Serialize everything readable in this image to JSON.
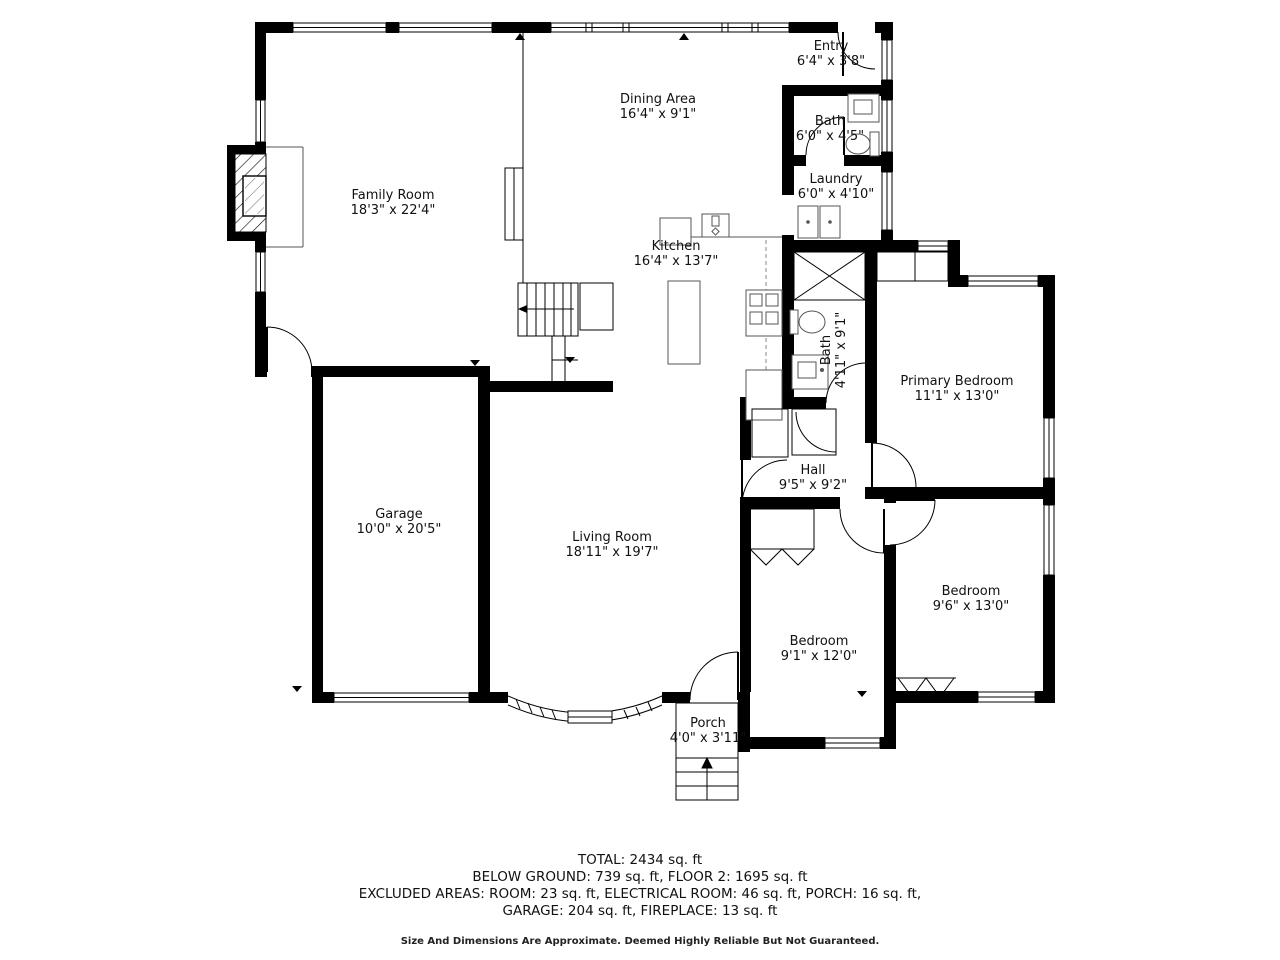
{
  "rooms": [
    {
      "name": "Entry",
      "dims": "6'4\" x 3'8\""
    },
    {
      "name": "Bath",
      "dims": "6'0\" x 4'5\""
    },
    {
      "name": "Laundry",
      "dims": "6'0\" x 4'10\""
    },
    {
      "name": "Dining Area",
      "dims": "16'4\" x 9'1\""
    },
    {
      "name": "Family Room",
      "dims": "18'3\" x 22'4\""
    },
    {
      "name": "Kitchen",
      "dims": "16'4\" x 13'7\""
    },
    {
      "name": "Bath",
      "dims": "4'11\" x 9'1\""
    },
    {
      "name": "Primary Bedroom",
      "dims": "11'1\" x 13'0\""
    },
    {
      "name": "Hall",
      "dims": "9'5\" x 9'2\""
    },
    {
      "name": "Garage",
      "dims": "10'0\" x 20'5\""
    },
    {
      "name": "Living Room",
      "dims": "18'11\" x 19'7\""
    },
    {
      "name": "Bedroom",
      "dims": "9'1\" x 12'0\""
    },
    {
      "name": "Bedroom",
      "dims": "9'6\" x 13'0\""
    },
    {
      "name": "Porch",
      "dims": "4'0\" x 3'11\""
    }
  ],
  "summary": {
    "line1": "TOTAL: 2434 sq. ft",
    "line2": "BELOW GROUND: 739 sq. ft, FLOOR 2: 1695 sq. ft",
    "line3": "EXCLUDED AREAS: ROOM: 23 sq. ft, ELECTRICAL ROOM: 46 sq. ft, PORCH: 16 sq. ft,",
    "line4": "GARAGE: 204 sq. ft, FIREPLACE: 13 sq. ft",
    "disclaimer": "Size And Dimensions Are Approximate. Deemed Highly Reliable But Not Guaranteed."
  },
  "colors": {
    "wall": "#000000",
    "background": "#ffffff"
  }
}
